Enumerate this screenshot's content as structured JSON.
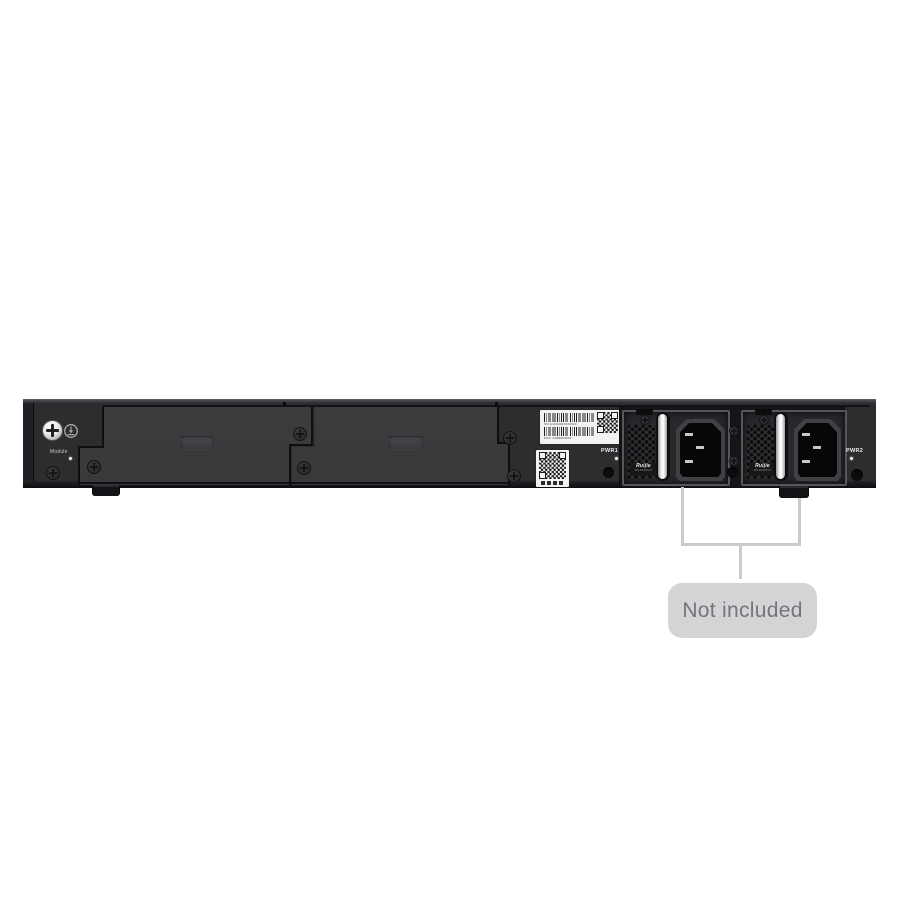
{
  "device": {
    "type": "switch-rear-panel",
    "module_label": "Module",
    "pwr1_label": "PWR1",
    "pwr2_label": "PWR2",
    "sn_text": "SN G1K02047200019",
    "mac_text": "MAC G089063802",
    "psu": {
      "brand": "Ruijie",
      "model": "RG-PA150I-F"
    }
  },
  "callout": {
    "text": "Not included"
  },
  "colors": {
    "background": "#ffffff",
    "chassis": "#2c2d2f",
    "cover": "#3a3b3c",
    "connector_line": "#c9cbcd",
    "callout_bg": "#d3d4d6",
    "callout_text": "#747578",
    "psu_handle": "#eeeff0"
  }
}
